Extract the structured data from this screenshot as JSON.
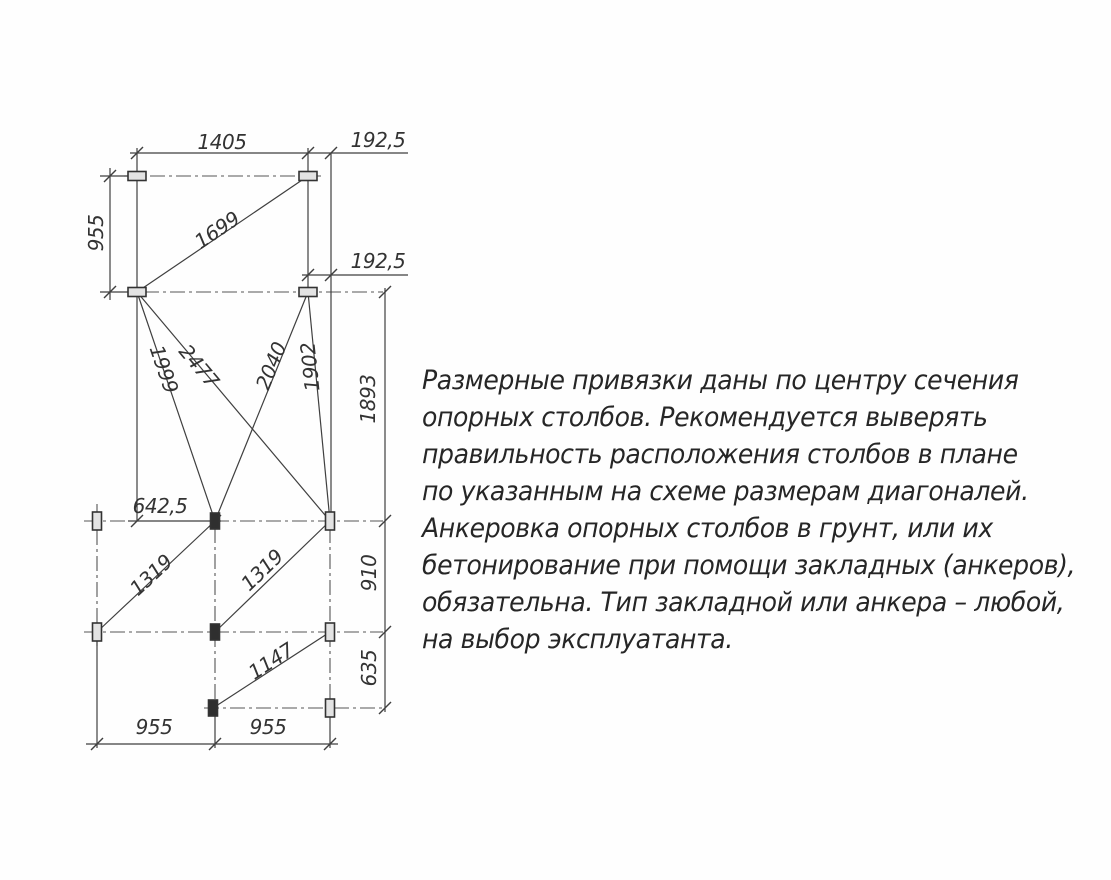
{
  "colors": {
    "line": "#3f3f3f",
    "centerline": "#555555",
    "text": "#2b2b2b",
    "post_fill": "#e3e3e3",
    "post_dark": "#2f2f2f",
    "background": "#fefefe"
  },
  "plan": {
    "dims": {
      "top_width": "1405",
      "top_offset": "192,5",
      "left_height": "955",
      "diag_1699": "1699",
      "mid_offset": "192,5",
      "diag_1999": "1999",
      "diag_2477": "2477",
      "diag_2040": "2040",
      "diag_1902": "1902",
      "right_h1893": "1893",
      "center_offset": "642,5",
      "diag_1319_left": "1319",
      "diag_1319_right": "1319",
      "right_h910": "910",
      "diag_1147": "1147",
      "right_h635": "635",
      "bottom_955_left": "955",
      "bottom_955_right": "955"
    }
  },
  "note": {
    "lines": [
      "Размерные привязки даны по центру сечения",
      "опорных столбов. Рекомендуется выверять",
      "правильность расположения столбов в плане",
      "по указанным на схеме размерам диагоналей.",
      "Анкеровка опорных столбов в грунт, или их",
      "бетонирование при помощи закладных (анкеров),",
      "обязательна. Тип закладной или анкера – любой,",
      "на выбор эксплуатанта."
    ]
  }
}
